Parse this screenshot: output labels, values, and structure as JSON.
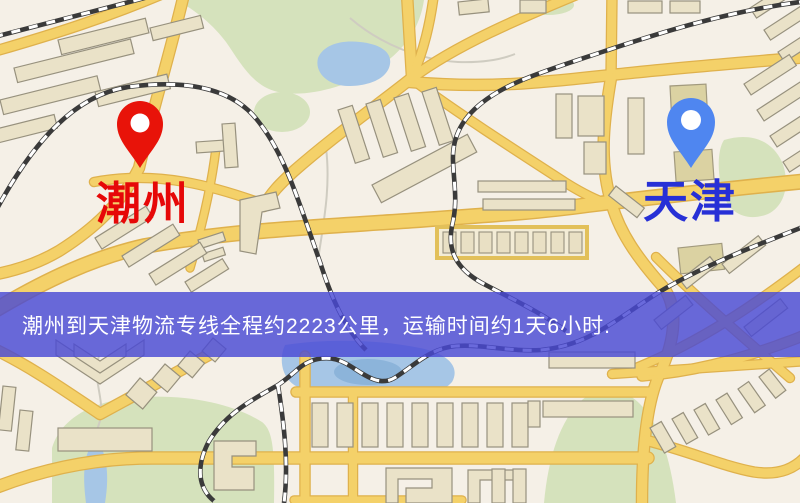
{
  "map": {
    "origin": {
      "label": "潮州",
      "label_color": "#e60808",
      "pin_color": "#e81309",
      "pin_icon": "red-location-pin"
    },
    "destination": {
      "label": "天津",
      "label_color": "#2730d6",
      "pin_color": "#4f86f0",
      "pin_icon": "blue-location-pin"
    },
    "banner": {
      "text": "潮州到天津物流专线全程约2223公里，运输时间约1天6小时.",
      "bg_color": "rgba(73,73,212,0.82)",
      "text_color": "#ffffff",
      "distance_km": "2223",
      "duration": "1天6小时"
    },
    "palette": {
      "background": "#f5f0e7",
      "road_fill": "#f4d169",
      "road_casing": "#dfb14c",
      "building_fill": "#eae2c8",
      "building_stroke": "#97917e",
      "park_green": "#d5e2bc",
      "water_blue": "#a6c6e6",
      "railway_dark": "#3a3a3a"
    }
  }
}
